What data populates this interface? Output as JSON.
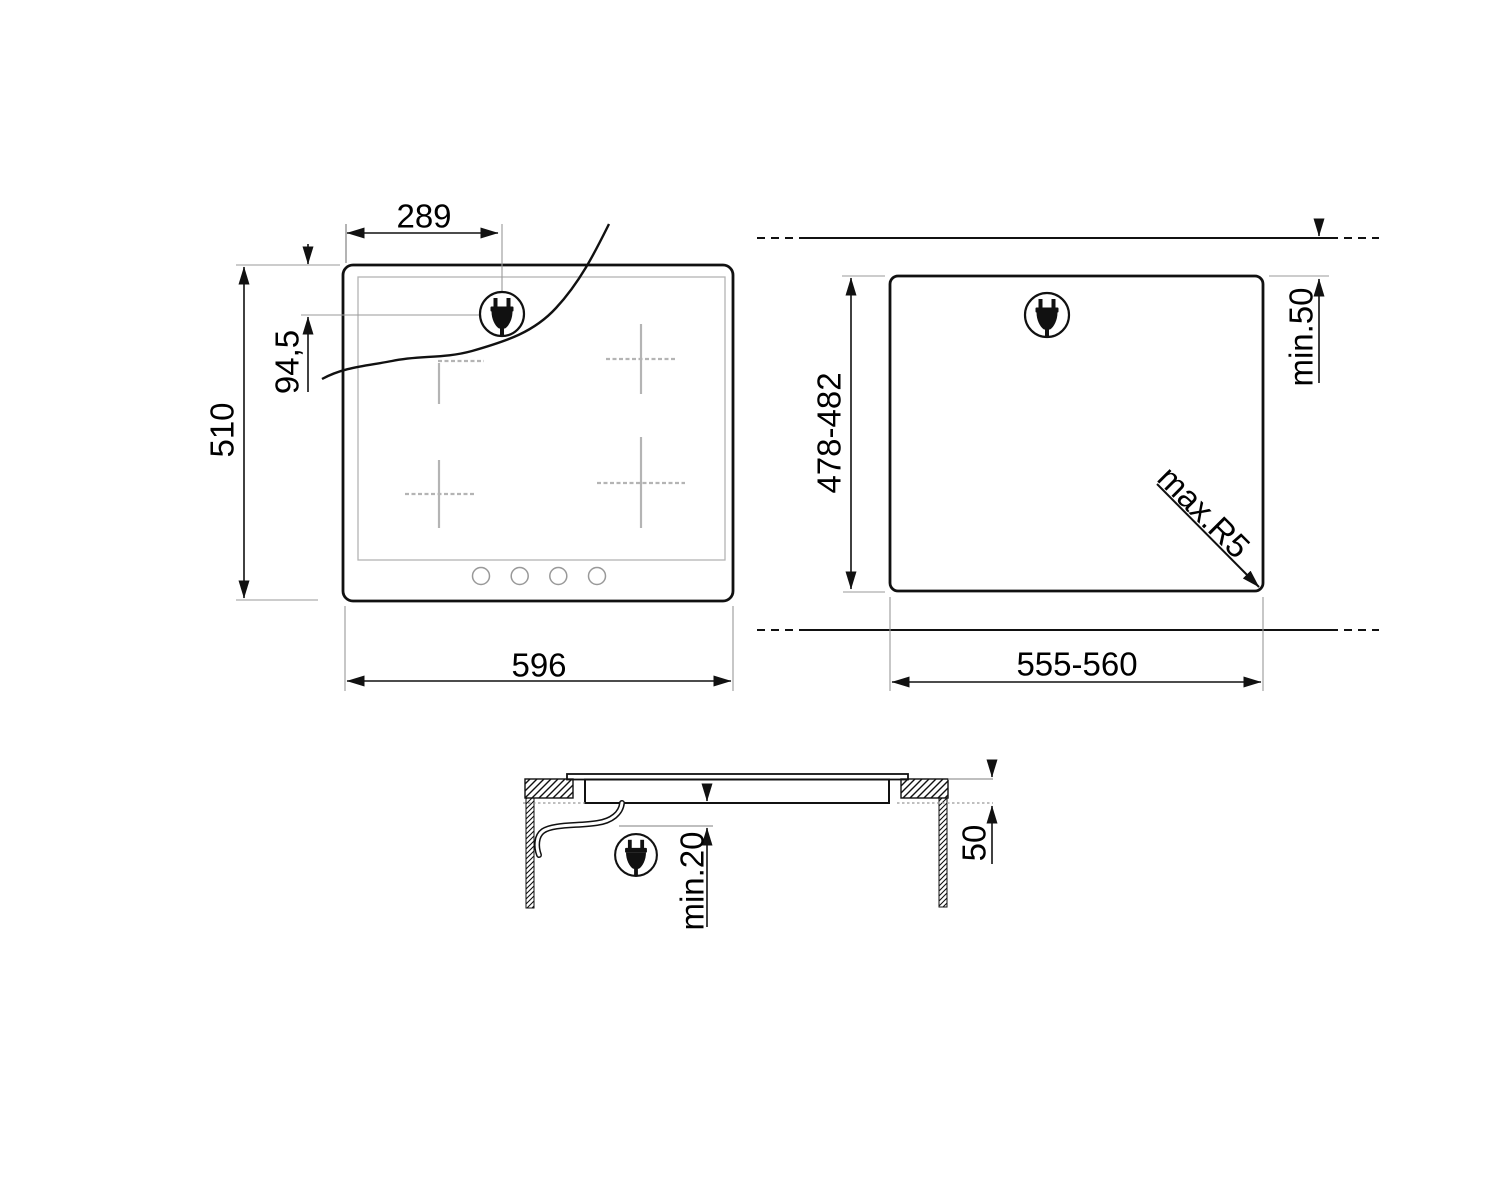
{
  "page": {
    "background": "#ffffff",
    "line_color": "#111111",
    "thin_line_color": "#999999",
    "burner_line_color": "#b4b4b4"
  },
  "icons": {
    "power_plug": "power-plug-icon"
  },
  "views": {
    "front": {
      "title": "hob front view",
      "dimensions": {
        "plug_offset_x": "289",
        "plug_offset_y": "94,5",
        "depth": "510",
        "width": "596"
      }
    },
    "cutout": {
      "title": "worktop cutout view",
      "dimensions": {
        "depth": "478-482",
        "width": "555-560",
        "rear_clearance": "min.50",
        "corner_radius": "max.R5"
      }
    },
    "section": {
      "title": "installation section view",
      "dimensions": {
        "clearance_below": "min.20",
        "worktop_thickness": "50"
      }
    }
  }
}
